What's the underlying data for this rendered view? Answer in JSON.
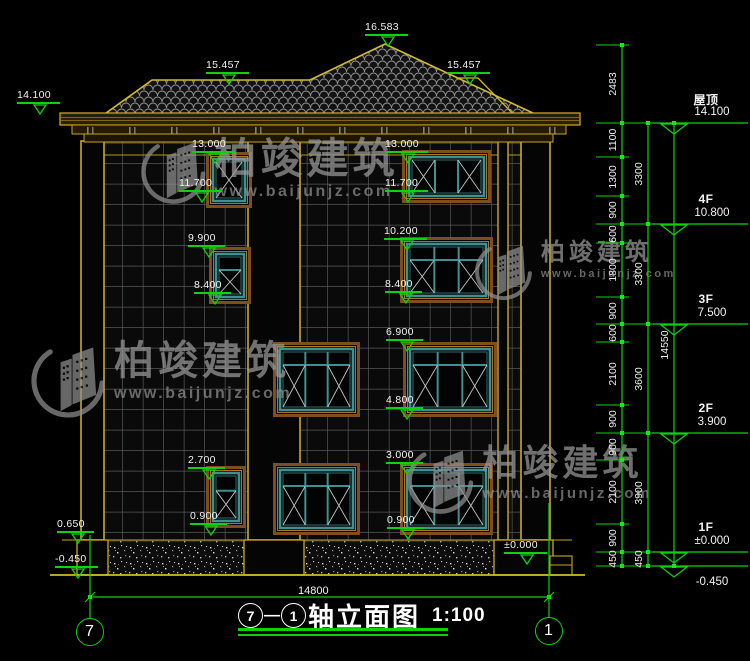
{
  "title": {
    "axis_from": "7",
    "dash": "—",
    "axis_to": "1",
    "name": "轴立面图",
    "scale": "1:100"
  },
  "watermark": {
    "name": "柏竣建筑",
    "url": "www.baijunjz.com"
  },
  "bottom_dim": {
    "label": "14800",
    "x1": 90,
    "x2": 549,
    "y": 597,
    "label_x": 318,
    "label_y": 586
  },
  "levels": [
    {
      "name": "屋顶",
      "value": "14.100",
      "y": 123
    },
    {
      "name": "4F",
      "value": "10.800",
      "y": 224
    },
    {
      "name": "3F",
      "value": "7.500",
      "y": 324
    },
    {
      "name": "2F",
      "value": "3.900",
      "y": 433
    },
    {
      "name": "1F",
      "value": "±0.000",
      "y": 552
    },
    {
      "name": "",
      "value": "-0.450",
      "y": 566,
      "below": true
    }
  ],
  "facade_markers": [
    {
      "label": "16.583",
      "x": 365,
      "y": 22
    },
    {
      "label": "15.457",
      "x": 206,
      "y": 60
    },
    {
      "label": "15.457",
      "x": 447,
      "y": 60
    },
    {
      "label": "14.100",
      "x": 17,
      "y": 90
    },
    {
      "label": "13.000",
      "x": 192,
      "y": 139
    },
    {
      "label": "13.000",
      "x": 385,
      "y": 139
    },
    {
      "label": "11.700",
      "x": 179,
      "y": 178
    },
    {
      "label": "11.700",
      "x": 385,
      "y": 178
    },
    {
      "label": "9.900",
      "x": 188,
      "y": 233
    },
    {
      "label": "10.200",
      "x": 384,
      "y": 226
    },
    {
      "label": "8.400",
      "x": 194,
      "y": 280
    },
    {
      "label": "8.400",
      "x": 385,
      "y": 279
    },
    {
      "label": "6.900",
      "x": 386,
      "y": 327
    },
    {
      "label": "4.800",
      "x": 386,
      "y": 395
    },
    {
      "label": "2.700",
      "x": 188,
      "y": 455
    },
    {
      "label": "0.900",
      "x": 190,
      "y": 511
    },
    {
      "label": "3.000",
      "x": 386,
      "y": 450
    },
    {
      "label": "0.900",
      "x": 387,
      "y": 515
    },
    {
      "label": "0.650",
      "x": 57,
      "y": 519
    },
    {
      "label": "-0.450",
      "x": 55,
      "y": 554
    },
    {
      "label": "±0.000",
      "x": 504,
      "y": 540
    }
  ],
  "chains": [
    {
      "x": 622,
      "ticks": [
        45,
        123,
        157,
        196,
        224,
        243,
        297,
        324,
        342,
        405,
        433,
        460,
        524,
        552,
        566
      ],
      "values": [
        "2483",
        "1100",
        "1300",
        "900",
        "600",
        "1800",
        "900",
        "600",
        "2100",
        "900",
        "900",
        "2100",
        "900",
        "450"
      ]
    },
    {
      "x": 648,
      "ticks": [
        123,
        224,
        324,
        433,
        552,
        566
      ],
      "values": [
        "3300",
        "3300",
        "3600",
        "3900",
        "450"
      ]
    },
    {
      "x": 674,
      "ticks": [
        123,
        566
      ],
      "values": [
        "14550"
      ]
    }
  ],
  "axes": [
    {
      "label": "7",
      "x": 90,
      "y1": 535,
      "y2": 618,
      "cy": 632
    },
    {
      "label": "1",
      "x": 549,
      "y1": 503,
      "y2": 617,
      "cy": 631
    }
  ],
  "drawing": {
    "windows": [
      {
        "x": 206,
        "y": 152,
        "w": 46,
        "h": 56,
        "type": "single"
      },
      {
        "x": 209,
        "y": 247,
        "w": 42,
        "h": 57,
        "type": "stack2"
      },
      {
        "x": 206,
        "y": 466,
        "w": 40,
        "h": 62,
        "type": "stack2"
      },
      {
        "x": 402,
        "y": 150,
        "w": 89,
        "h": 53,
        "type": "triple"
      },
      {
        "x": 400,
        "y": 237,
        "w": 93,
        "h": 66,
        "type": "transom3"
      },
      {
        "x": 273,
        "y": 342,
        "w": 87,
        "h": 75,
        "type": "transom3"
      },
      {
        "x": 403,
        "y": 342,
        "w": 94,
        "h": 75,
        "type": "transom3"
      },
      {
        "x": 273,
        "y": 463,
        "w": 87,
        "h": 72,
        "type": "transom3"
      },
      {
        "x": 400,
        "y": 463,
        "w": 93,
        "h": 72,
        "type": "transom3"
      }
    ],
    "watermark_spots": [
      {
        "x": 140,
        "y": 136,
        "logo": 70,
        "name_size": 42,
        "url_size": 16
      },
      {
        "x": 474,
        "y": 240,
        "logo": 62,
        "name_size": 24,
        "url_size": 11
      },
      {
        "x": 30,
        "y": 340,
        "logo": 80,
        "name_size": 40,
        "url_size": 16
      },
      {
        "x": 406,
        "y": 444,
        "logo": 72,
        "name_size": 36,
        "url_size": 15
      }
    ]
  }
}
